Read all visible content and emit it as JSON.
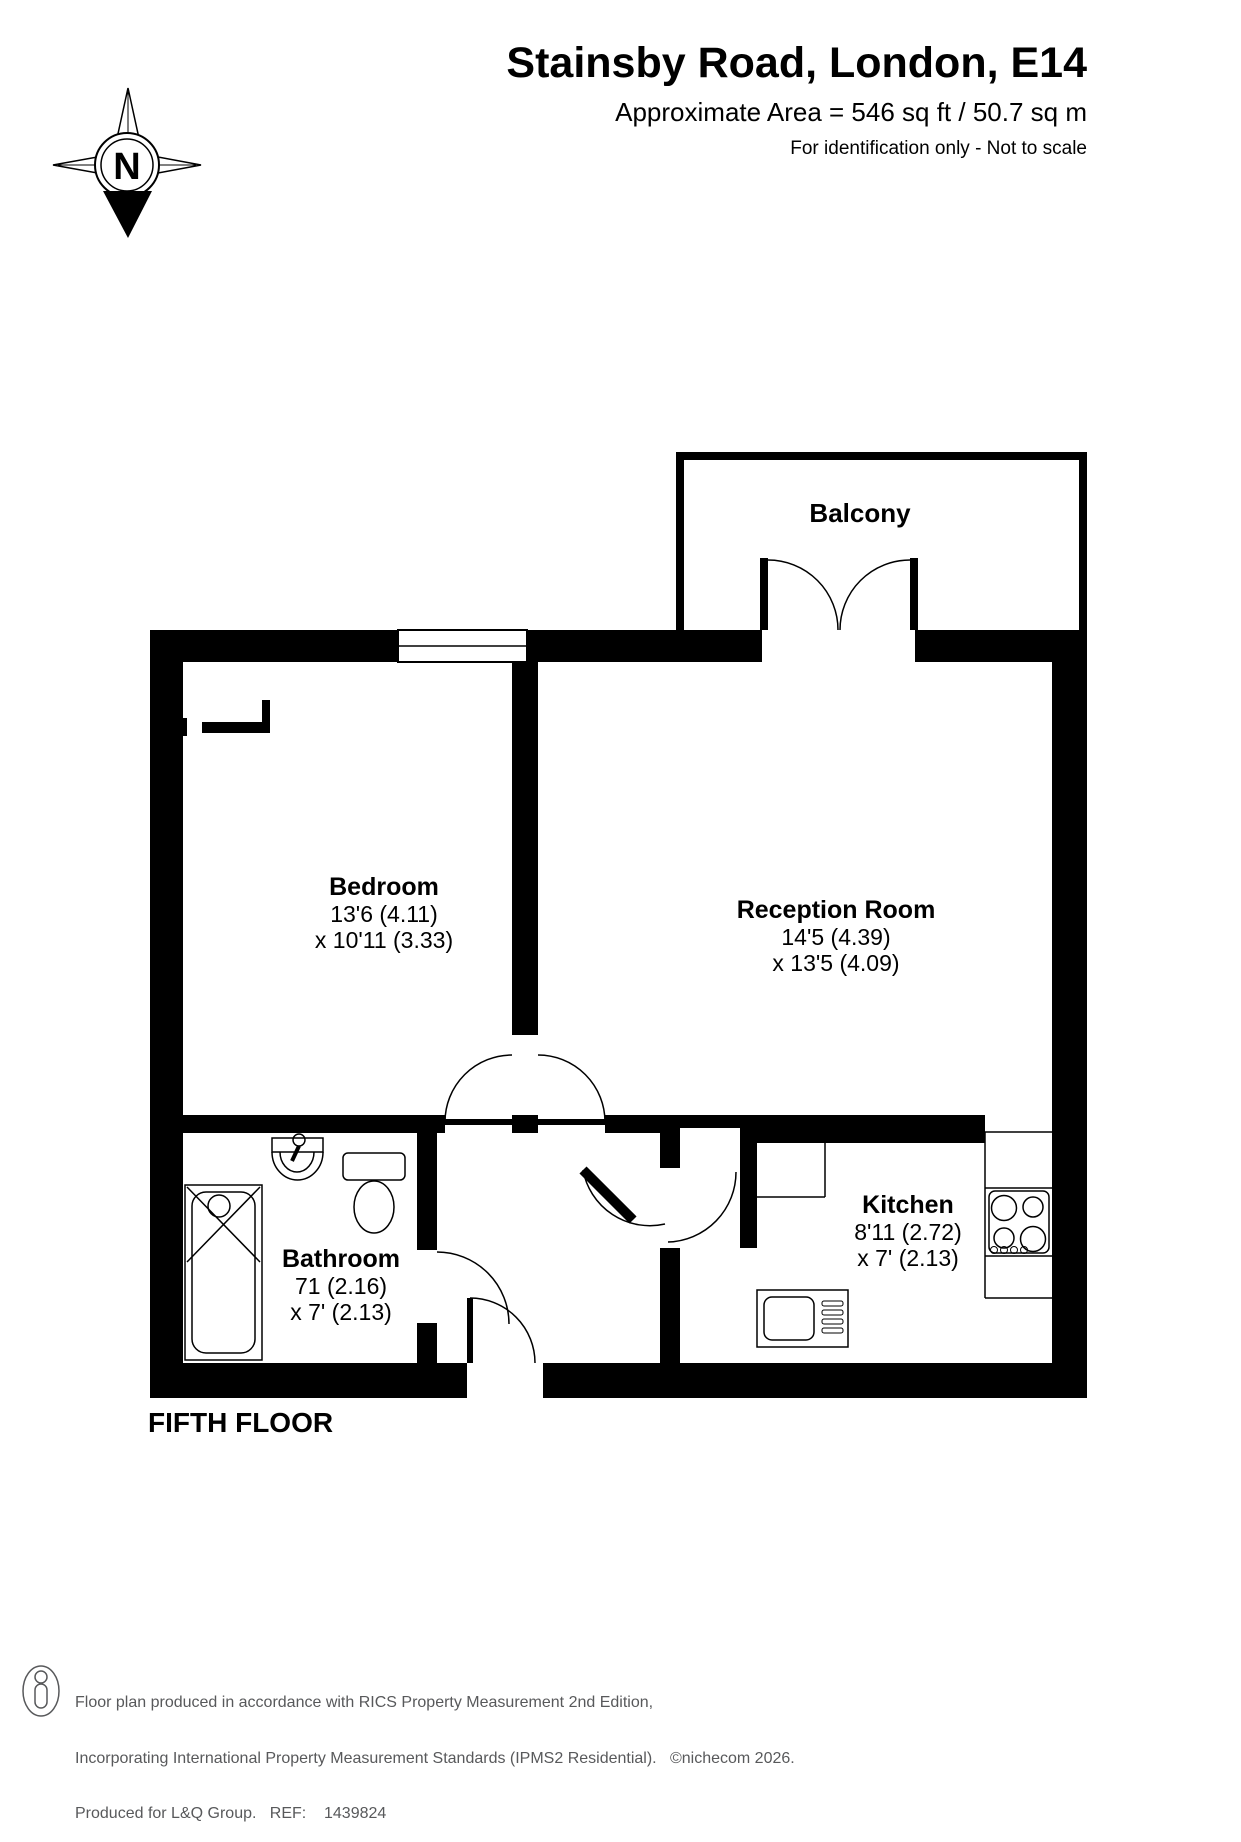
{
  "header": {
    "title": "Stainsby Road, London, E14",
    "area": "Approximate Area = 546 sq ft / 50.7 sq m",
    "note": "For identification only - Not to scale"
  },
  "compass": {
    "north_label": "N"
  },
  "plan": {
    "floor_label": "FIFTH FLOOR",
    "rooms": {
      "balcony": {
        "name": "Balcony"
      },
      "bedroom": {
        "name": "Bedroom",
        "dims1": "13'6 (4.11)",
        "dims2": "x 10'11 (3.33)"
      },
      "reception": {
        "name": "Reception Room",
        "dims1": "14'5 (4.39)",
        "dims2": "x 13'5 (4.09)"
      },
      "kitchen": {
        "name": "Kitchen",
        "dims1": "8'11 (2.72)",
        "dims2": "x 7' (2.13)"
      },
      "bathroom": {
        "name": "Bathroom",
        "dims1": "71 (2.16)",
        "dims2": "x 7' (2.13)"
      }
    }
  },
  "footer": {
    "line1": "Floor plan produced in accordance with RICS Property Measurement 2nd Edition,",
    "line2": "Incorporating International Property Measurement Standards (IPMS2 Residential).   ©nichecom 2026.",
    "line3": "Produced for L&Q Group.   REF:    1439824"
  },
  "colors": {
    "wall": "#000000",
    "footer_text": "#58595b"
  }
}
